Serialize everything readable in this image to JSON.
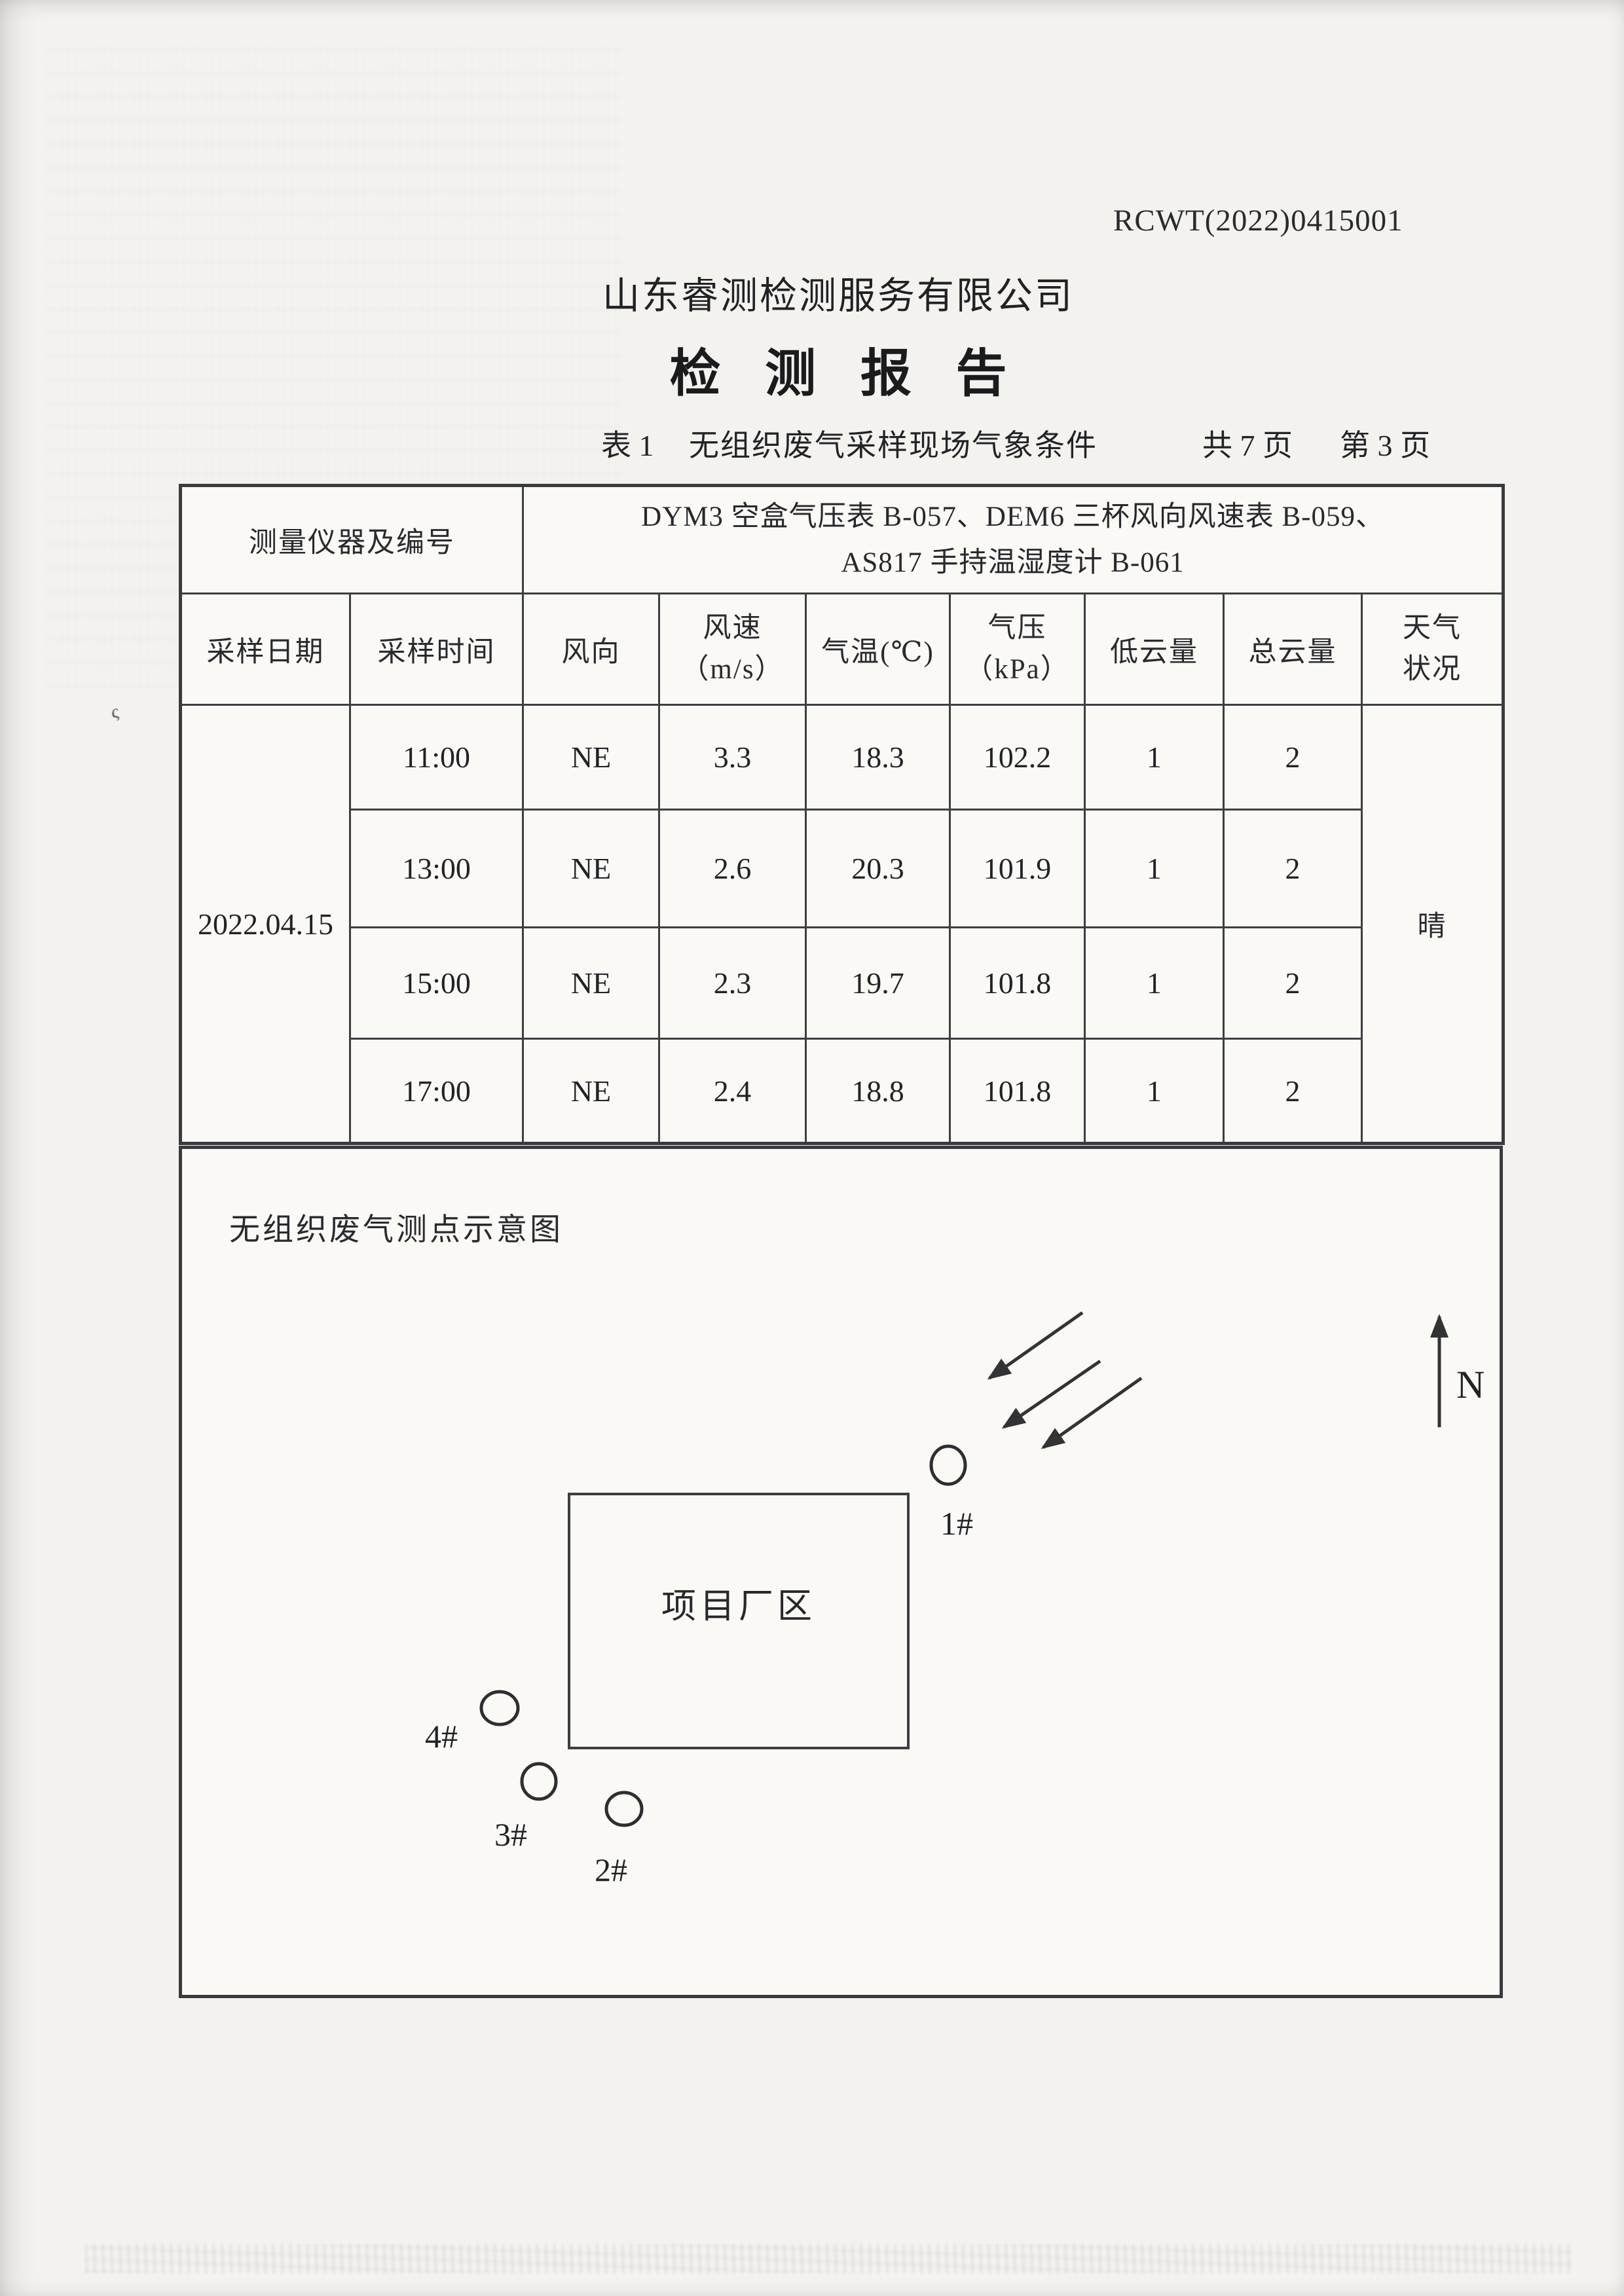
{
  "header": {
    "report_no": "RCWT(2022)0415001",
    "company": "山东睿测检测服务有限公司",
    "title": "检 测 报 告",
    "table_label": "表 1",
    "table_caption": "无组织废气采样现场气象条件",
    "total_pages": "共 7 页",
    "current_page": "第 3 页"
  },
  "table": {
    "instrument_label": "测量仪器及编号",
    "instrument_line1": "DYM3 空盒气压表 B-057、DEM6 三杯风向风速表 B-059、",
    "instrument_line2": "AS817 手持温湿度计 B-061",
    "col_date": "采样日期",
    "col_time": "采样时间",
    "col_wind_dir": "风向",
    "col_wind_speed_l1": "风速",
    "col_wind_speed_l2": "（m/s）",
    "col_temp": "气温(℃)",
    "col_press_l1": "气压",
    "col_press_l2": "（kPa）",
    "col_low_cloud": "低云量",
    "col_total_cloud": "总云量",
    "col_weather_l1": "天气",
    "col_weather_l2": "状况",
    "date": "2022.04.15",
    "weather": "晴",
    "rows": [
      {
        "time": "11:00",
        "wind_dir": "NE",
        "wind_speed": "3.3",
        "temp": "18.3",
        "pressure": "102.2",
        "low_cloud": "1",
        "total_cloud": "2"
      },
      {
        "time": "13:00",
        "wind_dir": "NE",
        "wind_speed": "2.6",
        "temp": "20.3",
        "pressure": "101.9",
        "low_cloud": "1",
        "total_cloud": "2"
      },
      {
        "time": "15:00",
        "wind_dir": "NE",
        "wind_speed": "2.3",
        "temp": "19.7",
        "pressure": "101.8",
        "low_cloud": "1",
        "total_cloud": "2"
      },
      {
        "time": "17:00",
        "wind_dir": "NE",
        "wind_speed": "2.4",
        "temp": "18.8",
        "pressure": "101.8",
        "low_cloud": "1",
        "total_cloud": "2"
      }
    ]
  },
  "diagram": {
    "title": "无组织废气测点示意图",
    "site_label": "项目厂区",
    "north_label": "N",
    "point1": "1#",
    "point2": "2#",
    "point3": "3#",
    "point4": "4#"
  }
}
